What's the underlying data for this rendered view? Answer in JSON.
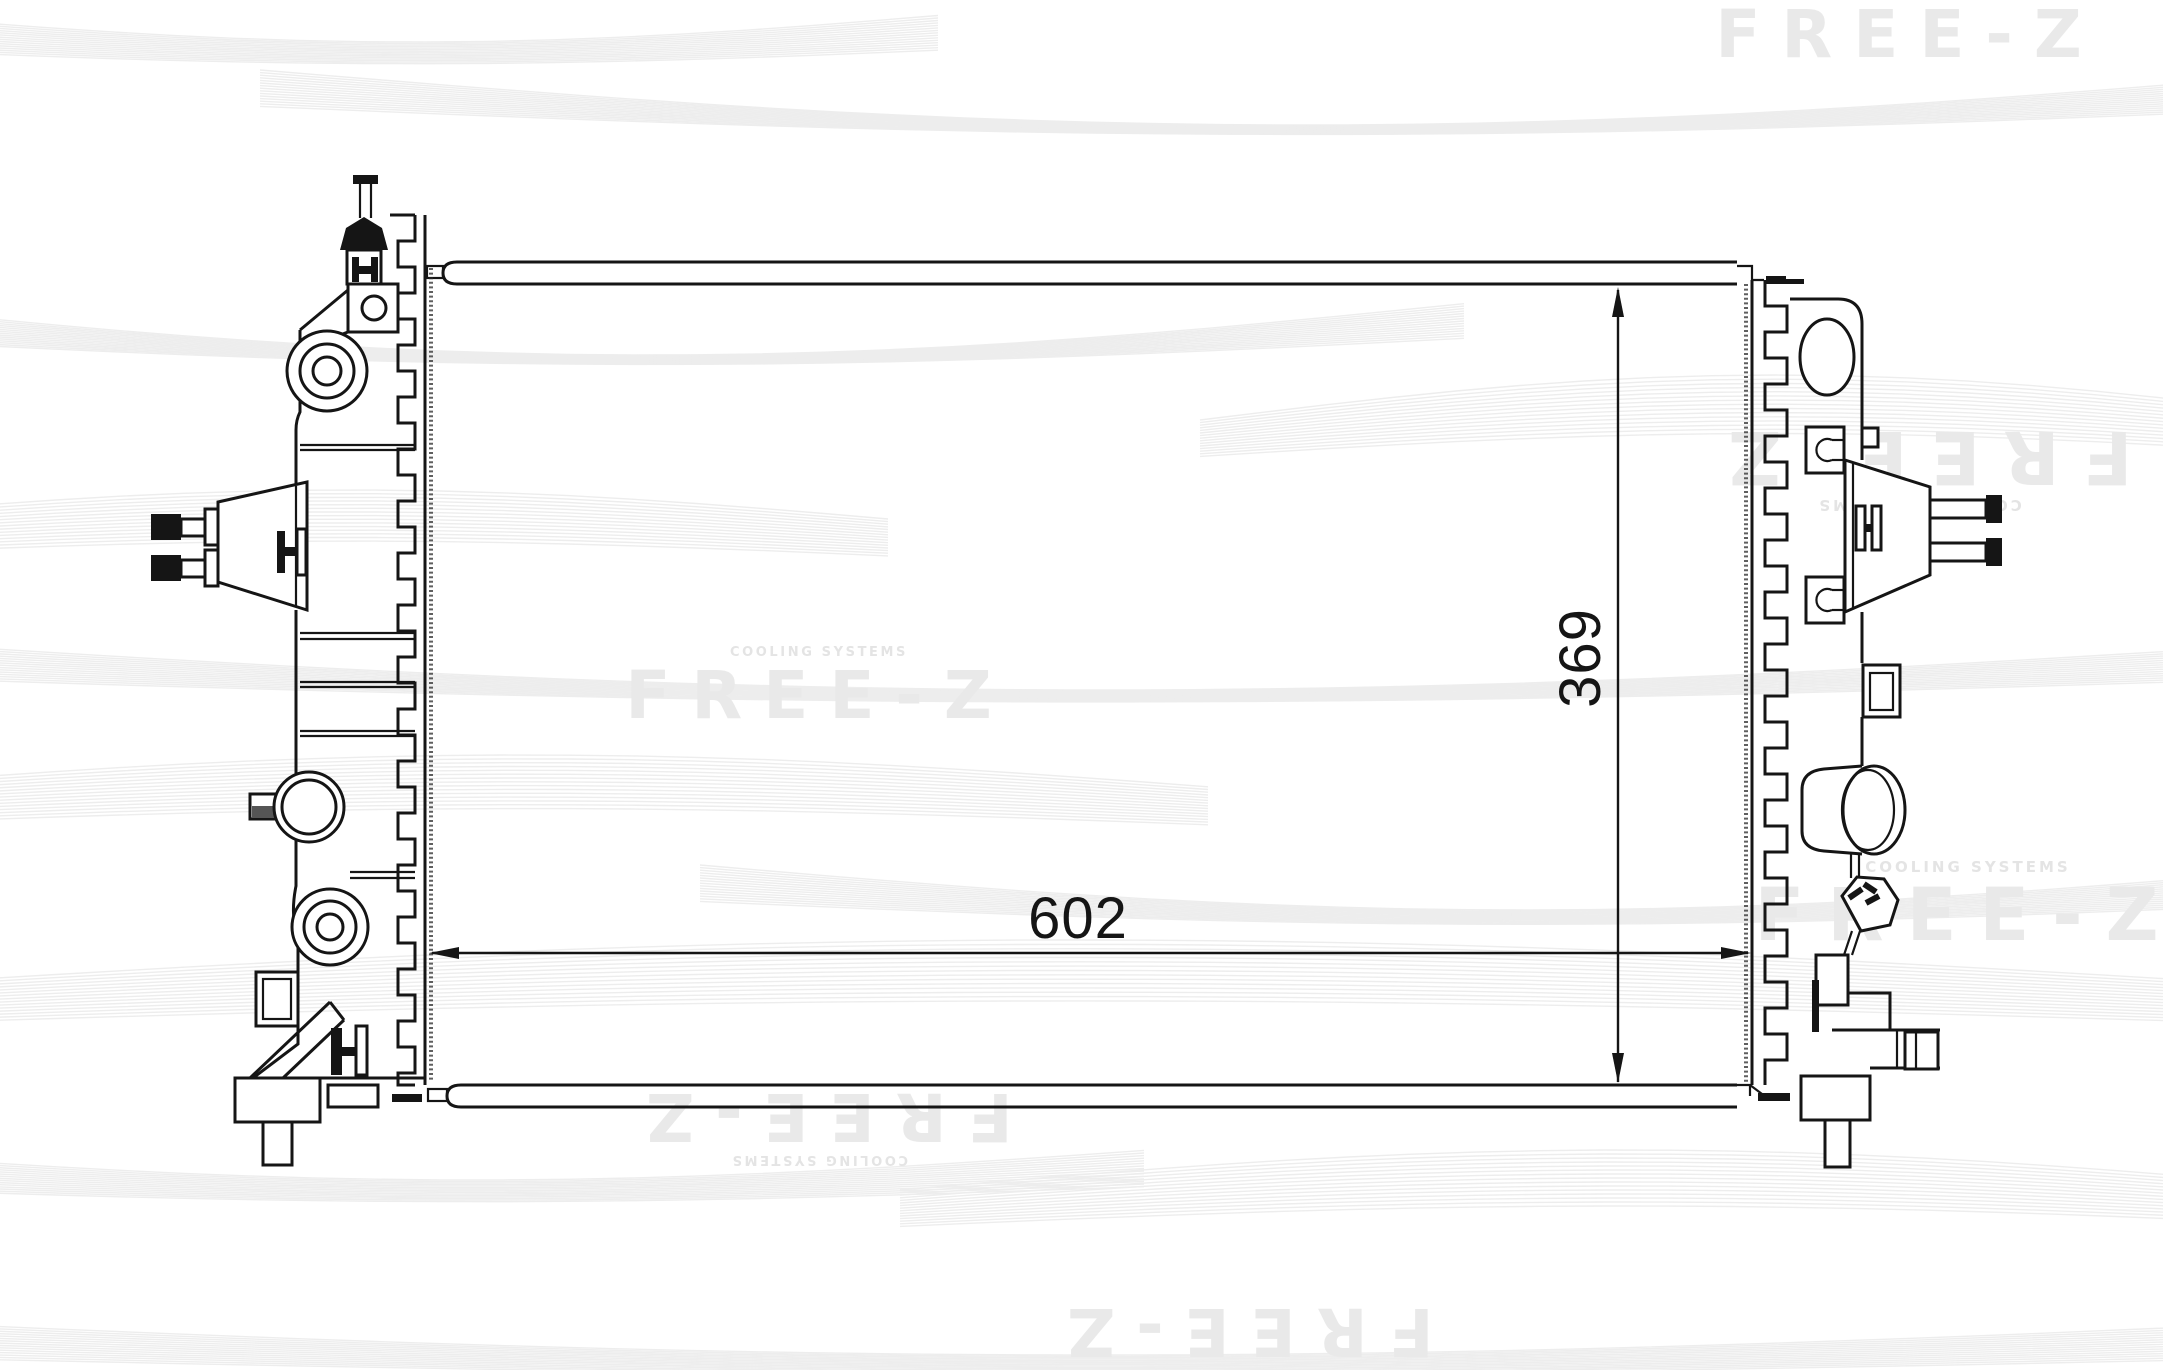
{
  "brand": {
    "logo_text": "FREE-Z",
    "tagline": "COOLING SYSTEMS",
    "watermark_color": "#e9e9e9"
  },
  "dimensions": {
    "width_label": "602",
    "height_label": "369"
  },
  "drawing": {
    "subject": "radiator-outline-technical-drawing",
    "line_color": "#151515"
  }
}
